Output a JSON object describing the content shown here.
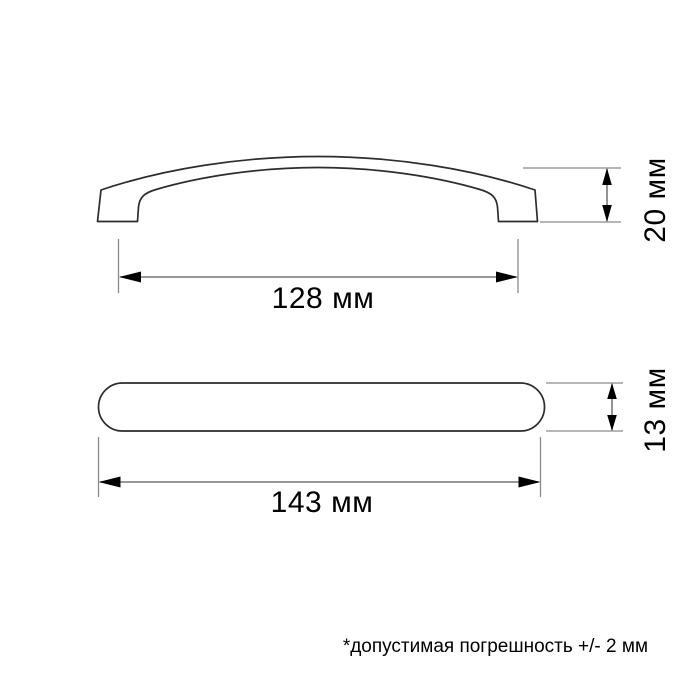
{
  "page": {
    "background": "#ffffff"
  },
  "drawing": {
    "type": "technical-dimension-drawing",
    "subject": "furniture-handle",
    "front_view": {
      "length_dim": {
        "label": "128 мм",
        "value": 128,
        "unit": "мм",
        "orientation": "horizontal"
      },
      "height_dim": {
        "label": "20 мм",
        "value": 20,
        "unit": "мм",
        "orientation": "vertical"
      }
    },
    "top_view": {
      "length_dim": {
        "label": "143 мм",
        "value": 143,
        "unit": "мм",
        "orientation": "horizontal"
      },
      "height_dim": {
        "label": "13 мм",
        "value": 13,
        "unit": "мм",
        "orientation": "vertical"
      }
    },
    "footnote": "*допустимая погрешность +/- 2 мм"
  },
  "colors": {
    "outline": "#2d2d2d",
    "extension_line": "#8a8a8a",
    "dimension_line": "#5a5a5a",
    "arrow": "#000000",
    "text": "#000000"
  }
}
